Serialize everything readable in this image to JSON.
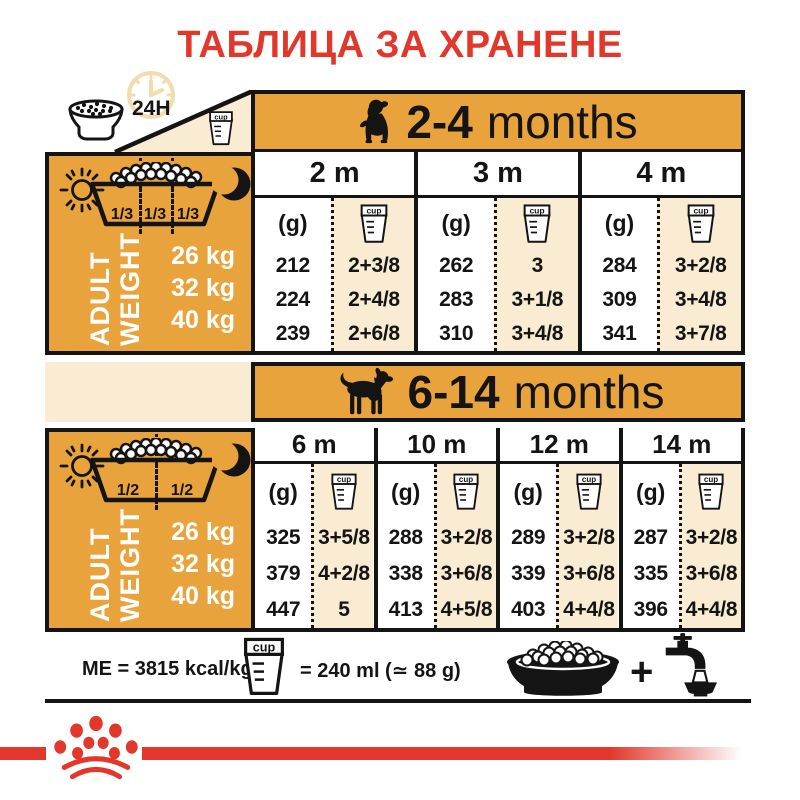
{
  "title": "ТАБЛИЦА ЗА ХРАНЕНЕ",
  "labels": {
    "hours": "24H",
    "cup": "cup",
    "grams": "(g)",
    "plus": "+"
  },
  "colors": {
    "orange": "#E9A33C",
    "cream": "#F9ECD3",
    "red": "#E2382C",
    "ink": "#141414"
  },
  "left_panel": {
    "adult": "ADULT",
    "weight": "WEIGHT",
    "weights": [
      "26 kg",
      "32 kg",
      "40 kg"
    ],
    "fractions_thirds": [
      "1/3",
      "1/3",
      "1/3"
    ],
    "fractions_halves": [
      "1/2",
      "1/2"
    ]
  },
  "section1": {
    "age": "2-4",
    "months": "months",
    "columns": [
      {
        "month": "2 m",
        "rows": [
          {
            "g": "212",
            "cup": "2+3/8"
          },
          {
            "g": "224",
            "cup": "2+4/8"
          },
          {
            "g": "239",
            "cup": "2+6/8"
          }
        ]
      },
      {
        "month": "3 m",
        "rows": [
          {
            "g": "262",
            "cup": "3"
          },
          {
            "g": "283",
            "cup": "3+1/8"
          },
          {
            "g": "310",
            "cup": "3+4/8"
          }
        ]
      },
      {
        "month": "4 m",
        "rows": [
          {
            "g": "284",
            "cup": "3+2/8"
          },
          {
            "g": "309",
            "cup": "3+4/8"
          },
          {
            "g": "341",
            "cup": "3+7/8"
          }
        ]
      }
    ]
  },
  "section2": {
    "age": "6-14",
    "months": "months",
    "columns": [
      {
        "month": "6 m",
        "rows": [
          {
            "g": "325",
            "cup": "3+5/8"
          },
          {
            "g": "379",
            "cup": "4+2/8"
          },
          {
            "g": "447",
            "cup": "5"
          }
        ]
      },
      {
        "month": "10 m",
        "rows": [
          {
            "g": "288",
            "cup": "3+2/8"
          },
          {
            "g": "338",
            "cup": "3+6/8"
          },
          {
            "g": "413",
            "cup": "4+5/8"
          }
        ]
      },
      {
        "month": "12 m",
        "rows": [
          {
            "g": "289",
            "cup": "3+2/8"
          },
          {
            "g": "339",
            "cup": "3+6/8"
          },
          {
            "g": "403",
            "cup": "4+4/8"
          }
        ]
      },
      {
        "month": "14 m",
        "rows": [
          {
            "g": "287",
            "cup": "3+2/8"
          },
          {
            "g": "335",
            "cup": "3+6/8"
          },
          {
            "g": "396",
            "cup": "4+4/8"
          }
        ]
      }
    ]
  },
  "footer": {
    "me": "ME = 3815 kcal/kg",
    "cup_equiv": "= 240 ml (≃ 88 g)"
  }
}
